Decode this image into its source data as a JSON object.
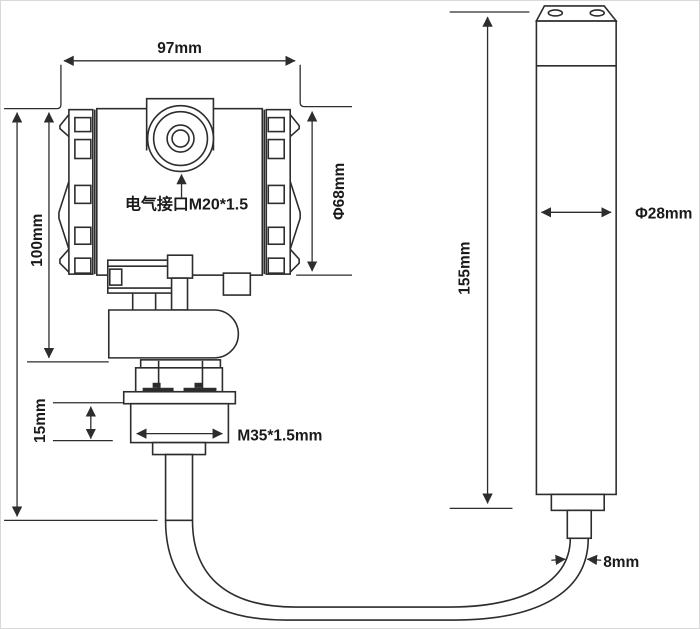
{
  "diagram": {
    "title_hint": "pressure level transmitter outline drawing",
    "colors": {
      "line": "#2d2d2d",
      "text": "#1a1a1a",
      "background": "#ffffff",
      "thread_mark": "#1c1c1c"
    },
    "labels": {
      "head_width": "97mm",
      "head_height": "100mm",
      "head_diameter": "Φ68mm",
      "electrical_port": "电气接口M20*1.5",
      "nut_height": "15mm",
      "thread_spec": "M35*1.5mm",
      "probe_length": "155mm",
      "probe_diameter": "Φ28mm",
      "cable_diameter": "8mm"
    }
  }
}
